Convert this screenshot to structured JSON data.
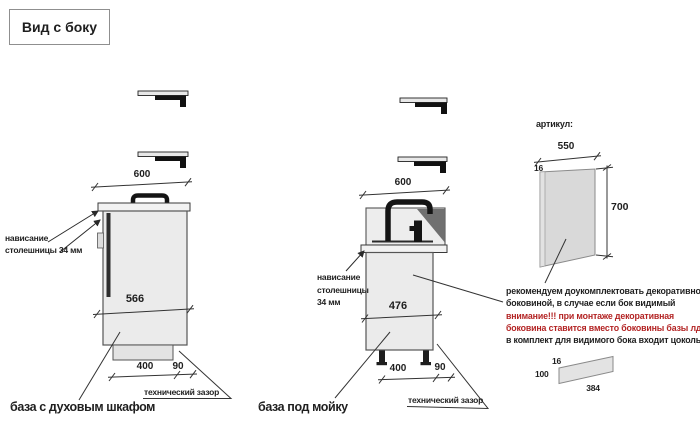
{
  "title": "Вид с боку",
  "oven_cabinet": {
    "name": "база с духовым шкафом",
    "dim_top": "600",
    "dim_front": "566",
    "dim_depth": "400",
    "dim_gap": "90",
    "gap_note": "технический зазор",
    "overhang_line1": "нависание",
    "overhang_line2": "столешницы 34 мм"
  },
  "sink_cabinet": {
    "name": "база под мойку",
    "dim_top": "600",
    "dim_front": "476",
    "dim_depth": "400",
    "dim_gap": "90",
    "gap_note": "технический зазор",
    "overhang_line1": "нависание",
    "overhang_line2": "столешницы",
    "overhang_line3": "34 мм"
  },
  "side_panel": {
    "article_label": "артикул:",
    "dim_width": "550",
    "dim_thickness": "16",
    "dim_height": "700",
    "note_line1": "рекомендуем доукомплектовать декоративной",
    "note_line2": "боковиной, в случае если бок видимый",
    "note_line3": "внимание!!! при монтаже декоративная",
    "note_line4": "боковина ставится вместо боковины базы лдсп",
    "note_line5": "в комплект для видимого бока входит цоколь:"
  },
  "plinth_part": {
    "dim_thickness": "16",
    "dim_height": "100",
    "dim_length": "384"
  },
  "colors": {
    "warning_red": "#b32424",
    "text_black": "#1f1f1f",
    "cabinet_fill": "#ebebeb",
    "countertop_fill": "#f2f2f2",
    "panel_fill": "#d9d9d9",
    "sink_shadow": "#707070",
    "faucet_black": "#141414"
  }
}
